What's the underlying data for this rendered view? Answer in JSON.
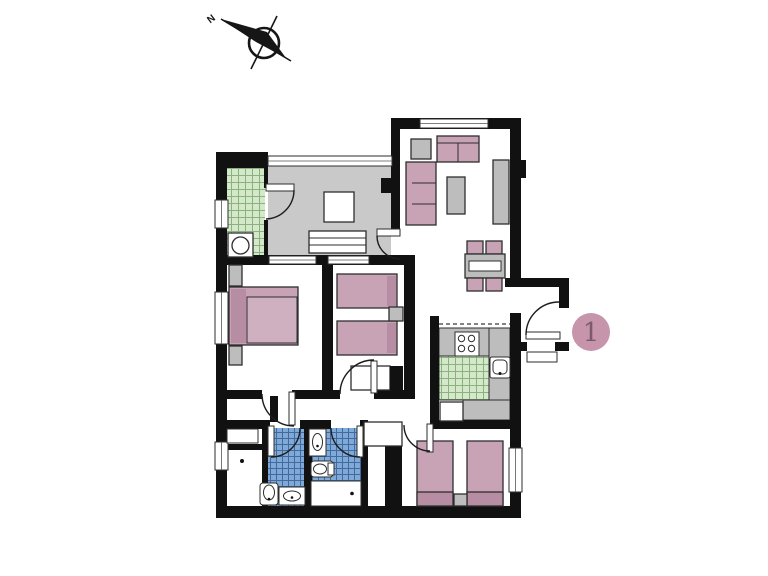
{
  "figure": {
    "type": "floor-plan",
    "description": "apartment floor plan with compass rose and unit marker"
  },
  "badge": {
    "number": "1"
  },
  "compass": {
    "label": "N"
  },
  "palette": {
    "wall": "#111111",
    "floor": "#ffffff",
    "terrace_floor": "#c9c9c9",
    "furniture_pink": "#c8a2b5",
    "furniture_pink_dark": "#b78da3",
    "furniture_pink_light": "#cfb0c1",
    "furniture_gray": "#bdbdbd",
    "tile_green": "#d6e8ca",
    "tile_green_line": "#8ab180",
    "tile_blue": "#7fa9d6",
    "tile_blue_line": "#44699c",
    "badge_fill": "#c694ab",
    "badge_text": "#7a5a6c"
  },
  "rooms": [
    "glazed-terrace",
    "laundry-strip",
    "living-room",
    "dining-area",
    "kitchen",
    "bedroom-1",
    "bedroom-2",
    "bedroom-3",
    "bathroom-1",
    "bathroom-2",
    "storage-room",
    "entry-vestibule",
    "hallway"
  ],
  "fixtures": [
    "washing-machine",
    "stove",
    "kitchen-sink",
    "fridge",
    "sofa",
    "armchair",
    "coffee-table",
    "tv-cabinet",
    "dining-table",
    "dining-chair",
    "double-bed",
    "single-bed",
    "nightstand",
    "desk",
    "toilet",
    "washbasin",
    "bathtub",
    "pedestal-sink",
    "closet"
  ]
}
